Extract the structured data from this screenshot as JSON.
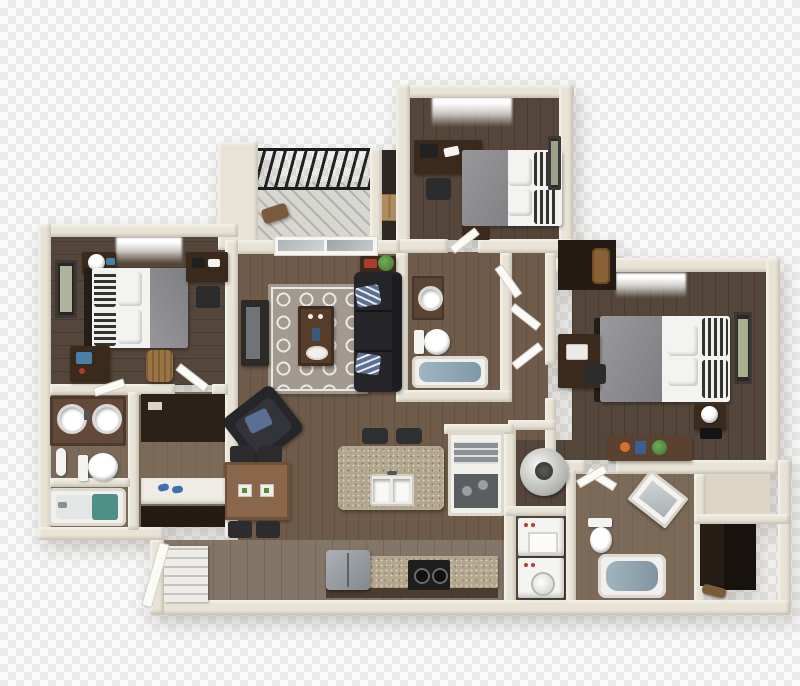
{
  "image": {
    "kind": "3D floor plan render",
    "view": "top-down isometric",
    "background": "transparency checkerboard (no visible text in image)"
  },
  "palette": {
    "checker_light": "#fbfbfb",
    "checker_dark": "#ebebeb",
    "wall_cream": "#e8e3d5",
    "wall_shadow": "#c9c2af",
    "wood_dark": "#54463a",
    "wood_mid": "#6e5b49",
    "wood_light": "#837567",
    "wood_tan": "#7b6a58",
    "balcony_deck": "#d7d6d1",
    "railing_black": "#1d1d1b",
    "rug_base": "#a29990",
    "rug_pattern": "#ece9e2",
    "sofa_black": "#26262a",
    "pillow_blue": "#5b6f94",
    "bed_linen_white": "#f3f3f1",
    "duvet_gray": "#8e8e90",
    "pillow_stripe_dark": "#33332f",
    "granite": "#b3a68f",
    "dining_wood": "#8a674a",
    "dark_furniture_wood": "#3a2a1c",
    "appliance_white": "#f4f4f2",
    "fridge_gray": "#9aa0a4",
    "stove_black": "#1e1e1e",
    "tub_water": "#8fa3ad",
    "teal_mat": "#4e8f86",
    "plant_green": "#4f8f3f",
    "books_red": "#b23a2a",
    "basket_tan": "#9c7443",
    "closet_dark": "#17120e",
    "cardboard": "#b08d5f",
    "slipper_blue": "#3f6fae"
  },
  "scene": {
    "rooms": [
      {
        "name": "balcony",
        "features": [
          "black metal railing",
          "gray plank decking",
          "patio chair",
          "storage closet",
          "cardboard box",
          "support column"
        ]
      },
      {
        "name": "bedroom-upper",
        "features": [
          "window",
          "desk with laptop and papers",
          "desk chair",
          "double bed with gray duvet",
          "striped accent pillows",
          "framed wall art",
          "nightstand"
        ]
      },
      {
        "name": "bedroom-left",
        "features": [
          "window",
          "framed wall art",
          "nightstand with lamp",
          "double bed with gray duvet",
          "striped accent pillows",
          "corner desk",
          "desk chair",
          "writing desk with blue laptop",
          "laundry basket"
        ]
      },
      {
        "name": "living-room",
        "features": [
          "sliding glass balcony door",
          "console table with red books and plant",
          "black three-seat sofa",
          "blue striped throw pillows",
          "patterned area rug",
          "coffee table with tray",
          "media console with tv",
          "black armchair with blue pillow"
        ]
      },
      {
        "name": "dining-area",
        "features": [
          "wood dining table",
          "four chairs",
          "two place settings"
        ]
      },
      {
        "name": "kitchen",
        "features": [
          "granite island with double sink and faucet",
          "two bar stools",
          "open pantry shelving",
          "refrigerator",
          "black cooktop range",
          "granite counter"
        ]
      },
      {
        "name": "bathroom-center",
        "features": [
          "granite vanity with round sink",
          "toilet",
          "bathtub with water",
          "open door"
        ]
      },
      {
        "name": "bathroom-left",
        "features": [
          "granite double vanity",
          "two round sinks",
          "towel roll",
          "toilet",
          "bathtub with teal mat"
        ]
      },
      {
        "name": "walk-in-closet-left",
        "features": [
          "dark shelving",
          "white bench shelf",
          "blue slippers"
        ]
      },
      {
        "name": "bedroom-right",
        "features": [
          "window",
          "double bed with gray duvet",
          "striped accent pillows",
          "white pillows",
          "framed wall art",
          "nightstand with lamp",
          "desk with laptop",
          "desk chair",
          "dresser with orange and blue decor and plant",
          "flat tv"
        ]
      },
      {
        "name": "upper-closet",
        "features": [
          "dark interior",
          "brown duffel bag"
        ]
      },
      {
        "name": "utility-closet",
        "features": [
          "water heater",
          "washer",
          "dryer with round dial and red buttons"
        ]
      },
      {
        "name": "bathroom-right",
        "features": [
          "toilet",
          "bathtub with water",
          "angled white vanity",
          "open door"
        ]
      },
      {
        "name": "wardrobe-closet-right",
        "features": [
          "dark wardrobe interior",
          "brown shoe"
        ]
      },
      {
        "name": "entry-hall",
        "features": [
          "staircase",
          "white stair railing",
          "light wood hallway floor"
        ]
      }
    ]
  }
}
